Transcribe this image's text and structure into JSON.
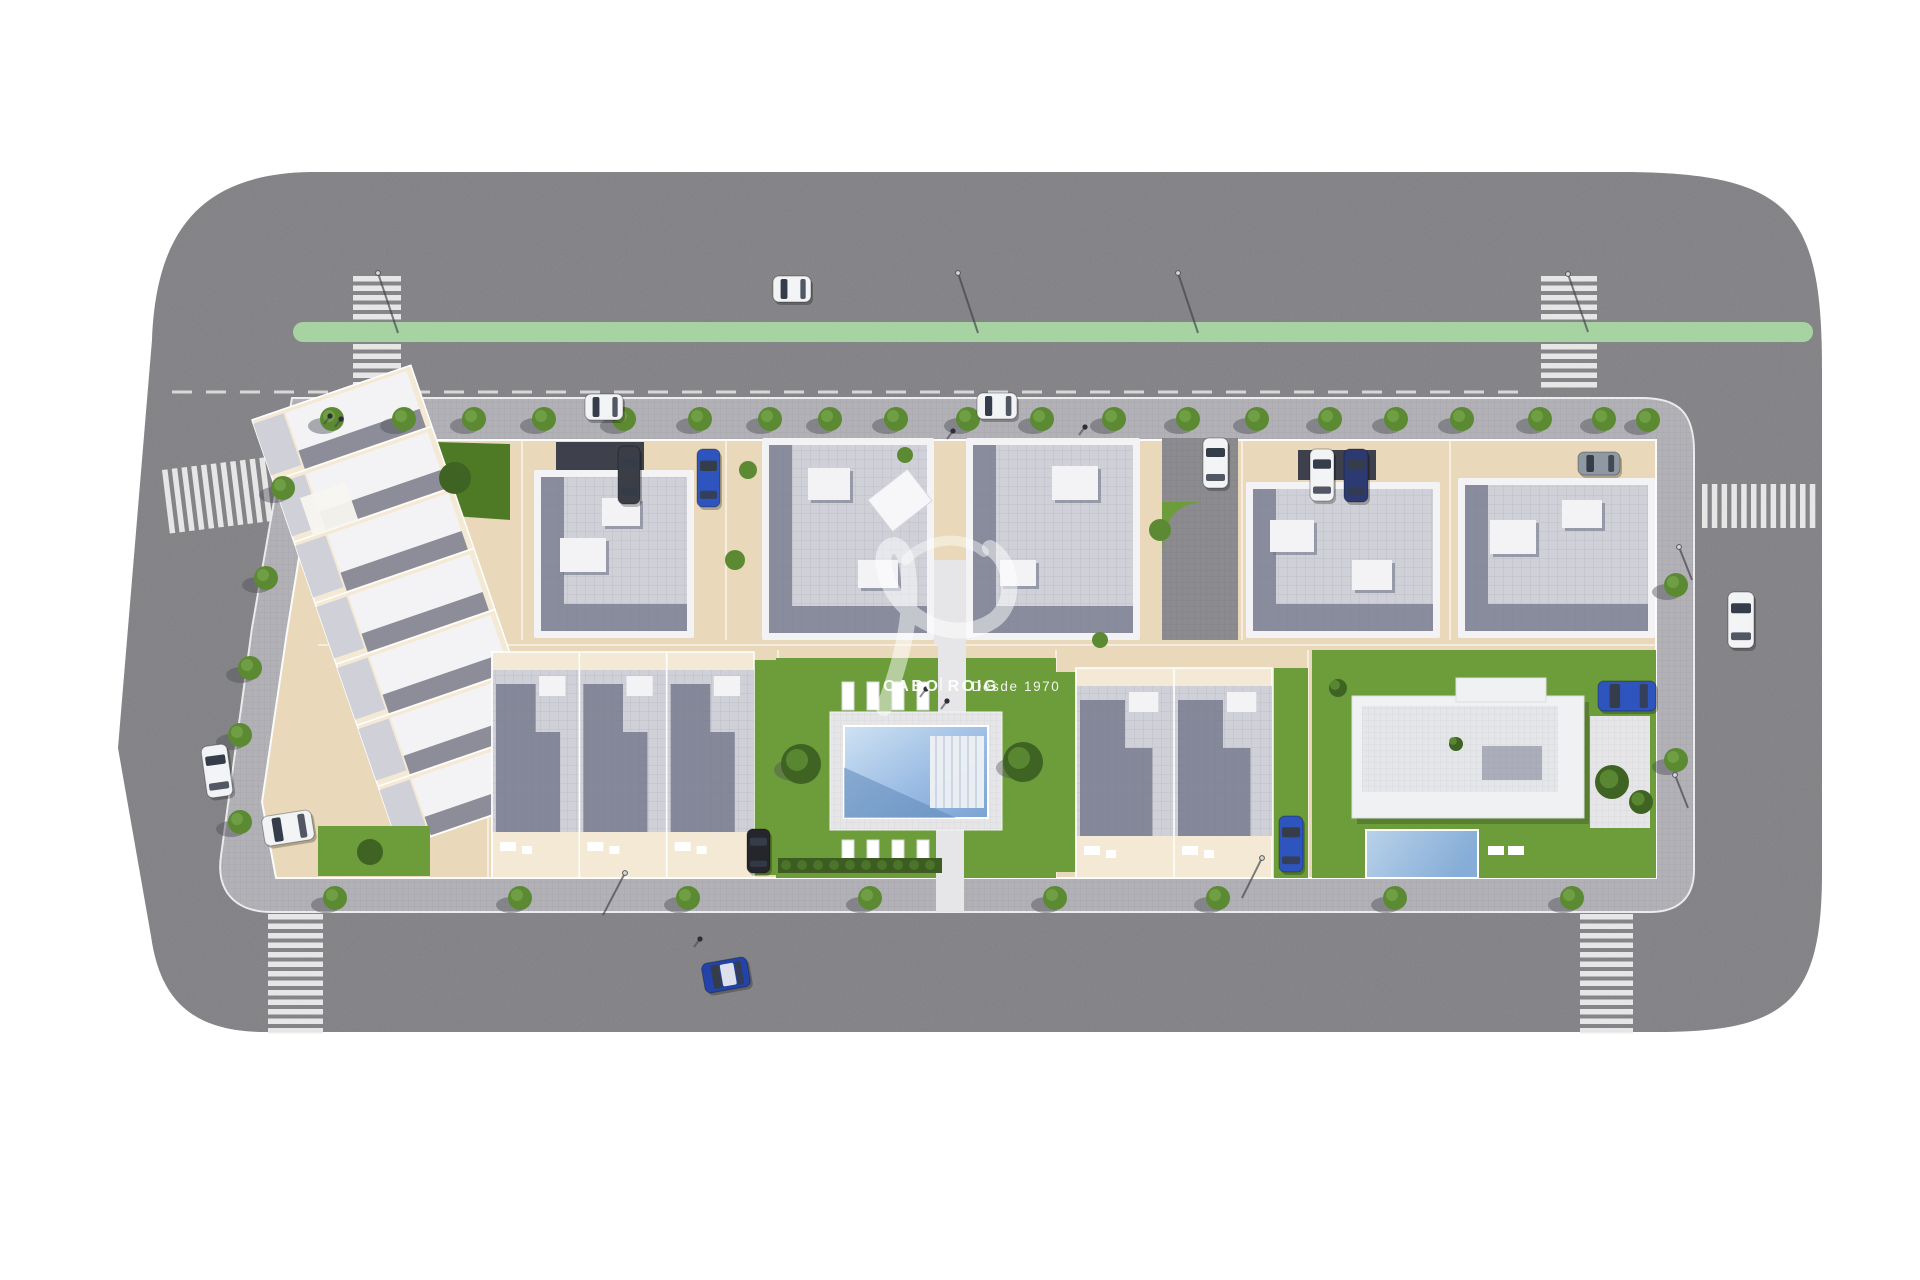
{
  "watermark": {
    "brand": "CABO ROIG",
    "tagline": "Desde 1970",
    "brand_x": 941,
    "brand_y": 691,
    "tag_x": 1016,
    "tag_y": 691,
    "swoosh1": "M 884,708 C 902,660 916,606 906,560 C 900,536 880,544 884,566 C 890,612 950,650 994,620 C 1018,602 1012,560 990,548",
    "swoosh2": "M 906,560 C 926,538 962,534 984,552"
  },
  "palette": {
    "asphalt": "#78787c",
    "driveway": "#8b8b90",
    "green_lane": "#a7d2a1",
    "sidewalk": "#b1b1b6",
    "curb": "#ececee",
    "block": "#e9d9ba",
    "block_light": "#f4e9d4",
    "lawn": "#6d9c3a",
    "lawn_dark": "#4e7a26",
    "hedge": "#3c5c22",
    "roof_white": "#f3f3f6",
    "roof_tile": "#cfd0d8",
    "roof_shadow": "#727689",
    "carport": "#3e414b",
    "deck": "#e6e6e8",
    "stripe": "#ebebeb",
    "car_white": "#f2f3f5",
    "car_blue": "#2e54bd",
    "car_blue2": "#2343a8",
    "car_navy": "#2c3a71",
    "car_black": "#25262c",
    "car_dark": "#3b3e47",
    "car_gray": "#9099a2",
    "glass": "#353c4a",
    "tree": "#5c8a33",
    "tree_dark": "#3f6323",
    "shadow": "#4e4f56"
  },
  "road": {
    "path": "M 310,172 L 1630,172 C 1790,174 1822,212 1822,368 L 1822,872 C 1822,1000 1788,1032 1658,1032 L 266,1032 C 192,1032 160,1000 151,936 L 118,748 L 152,340 C 156,232 200,174 310,172 Z",
    "green_lane": {
      "x": 293,
      "y": 322,
      "w": 1520,
      "h": 20,
      "r": 10
    },
    "dash_line": {
      "x1": 172,
      "y1": 392,
      "x2": 1532,
      "y2": 392
    }
  },
  "sidewalk_path": "M 292,398 L 1642,398 C 1680,398 1694,414 1694,452 L 1694,870 C 1694,898 1678,912 1650,912 L 272,912 C 234,912 216,890 221,856 L 252,628 Z",
  "block_path": "M 318,440 L 1656,440 L 1656,878 L 276,878 L 262,802 L 287,632 Z",
  "crosswalks": [
    {
      "type": "v",
      "x": 353,
      "y": 276,
      "w": 48,
      "count": 5,
      "pitch": 9.5,
      "rot": 0
    },
    {
      "type": "v",
      "x": 353,
      "y": 344,
      "w": 48,
      "count": 6,
      "pitch": 9.5,
      "rot": 0
    },
    {
      "type": "v",
      "x": 1541,
      "y": 276,
      "w": 56,
      "count": 5,
      "pitch": 9.5,
      "rot": 0
    },
    {
      "type": "v",
      "x": 1541,
      "y": 344,
      "w": 56,
      "count": 5,
      "pitch": 9.5,
      "rot": 0
    },
    {
      "type": "v",
      "x": 268,
      "y": 914,
      "w": 55,
      "count": 13,
      "pitch": 9.5,
      "rot": 0
    },
    {
      "type": "v",
      "x": 1580,
      "y": 914,
      "w": 53,
      "count": 13,
      "pitch": 9.5,
      "rot": 0
    },
    {
      "type": "h",
      "x": 162,
      "y": 470,
      "h": 64,
      "count": 12,
      "pitch": 9.8,
      "rot": -7
    },
    {
      "type": "h",
      "x": 1702,
      "y": 484,
      "h": 44,
      "count": 12,
      "pitch": 9.8,
      "rot": 0
    }
  ],
  "driveway": {
    "x": 1162,
    "y": 438,
    "w": 76,
    "h": 202,
    "green_corner": "M 1162,556 L 1162,502 L 1206,502 Q 1162,502 1162,556 Z",
    "car_index": 3
  },
  "terraced_west": {
    "tx": 252,
    "ty": 420,
    "rot": -19,
    "w": 168,
    "h": 452,
    "units": 7,
    "garden_top": "400,441 510,444 510,520 424,514",
    "garden_bottom": {
      "x": 318,
      "y": 826,
      "w": 112,
      "h": 50
    },
    "pergola": {
      "x": 300,
      "y": 498,
      "w": 48,
      "h": 40
    }
  },
  "apartments": [
    {
      "x": 534,
      "y": 470,
      "w": 160,
      "h": 168,
      "carport": {
        "x": 556,
        "y": 442,
        "w": 88,
        "h": 30
      },
      "boxes": [
        [
          560,
          538,
          46,
          34
        ],
        [
          602,
          498,
          38,
          28
        ]
      ]
    },
    {
      "x": 762,
      "y": 438,
      "w": 172,
      "h": 202,
      "boxes": [
        [
          808,
          468,
          42,
          32
        ],
        [
          858,
          560,
          40,
          28
        ]
      ],
      "diag": {
        "x": 868,
        "y": 500,
        "s": 50
      }
    },
    {
      "x": 966,
      "y": 438,
      "w": 174,
      "h": 202,
      "boxes": [
        [
          1052,
          466,
          46,
          34
        ],
        [
          1000,
          560,
          36,
          26
        ]
      ]
    },
    {
      "x": 1246,
      "y": 482,
      "w": 194,
      "h": 156,
      "carport": {
        "x": 1298,
        "y": 450,
        "w": 78,
        "h": 30
      },
      "boxes": [
        [
          1270,
          520,
          44,
          32
        ],
        [
          1352,
          560,
          40,
          30
        ]
      ]
    },
    {
      "x": 1458,
      "y": 478,
      "w": 197,
      "h": 160,
      "boxes": [
        [
          1490,
          520,
          46,
          34
        ],
        [
          1562,
          500,
          40,
          28
        ]
      ]
    }
  ],
  "court": {
    "x": 934,
    "y": 560,
    "w": 32,
    "h": 84
  },
  "townhouse_rows": [
    {
      "x": 492,
      "y": 652,
      "w": 262,
      "h": 226,
      "units": 3,
      "patio_h": 46,
      "lawns": [
        [
          754,
          660,
          22,
          215
        ]
      ]
    },
    {
      "x": 1076,
      "y": 668,
      "w": 196,
      "h": 210,
      "units": 2,
      "patio_h": 42,
      "lawns": [
        [
          1052,
          672,
          24,
          200
        ],
        [
          1274,
          668,
          34,
          210
        ]
      ]
    }
  ],
  "property_lines": {
    "v1": [
      522,
      726,
      1242,
      1450
    ],
    "v1y": [
      440,
      640
    ],
    "v2": [
      488,
      778,
      1056,
      1308
    ],
    "v2y": [
      650,
      878
    ],
    "hy": 645,
    "hx": [
      318,
      1656
    ]
  },
  "garden": {
    "lawn": {
      "x": 776,
      "y": 658,
      "w": 280,
      "h": 220
    },
    "deck": {
      "x": 830,
      "y": 712,
      "w": 172,
      "h": 118
    },
    "pool": {
      "x": 844,
      "y": 726,
      "w": 144,
      "h": 92
    },
    "steps": {
      "x": 930,
      "y": 736,
      "w": 54,
      "h": 72
    },
    "loungers_x": [
      842,
      867,
      892,
      917
    ],
    "loungers_y": [
      682,
      840
    ],
    "lounger": {
      "w": 12,
      "h": 28
    },
    "bushes": [
      [
        801,
        764,
        20
      ],
      [
        1023,
        762,
        20
      ]
    ],
    "hedge": {
      "x": 778,
      "y": 858,
      "w": 164,
      "h": 15
    },
    "path_bottom": {
      "x": 936,
      "y": 828,
      "w": 28,
      "h": 84
    },
    "path_top": {
      "x": 938,
      "y": 586,
      "w": 28,
      "h": 126
    }
  },
  "villa": {
    "plot": {
      "x": 1312,
      "y": 650,
      "w": 344,
      "h": 228
    },
    "base": {
      "x": 1352,
      "y": 696,
      "w": 232,
      "h": 122
    },
    "roof": {
      "x": 1362,
      "y": 706,
      "w": 196,
      "h": 86
    },
    "wing": {
      "x": 1456,
      "y": 678,
      "w": 90,
      "h": 24
    },
    "pool": {
      "x": 1366,
      "y": 830,
      "w": 112,
      "h": 48
    },
    "path": {
      "x": 1590,
      "y": 716,
      "w": 60,
      "h": 112
    },
    "bushes": [
      [
        1612,
        782,
        17
      ],
      [
        1641,
        802,
        12
      ],
      [
        1338,
        688,
        9
      ],
      [
        1456,
        744,
        7
      ]
    ],
    "loungers": [
      [
        1488,
        846
      ],
      [
        1508,
        846
      ]
    ]
  },
  "trees": {
    "top_y": 419,
    "top_x": [
      332,
      404,
      474,
      544,
      624,
      700,
      770,
      830,
      896,
      968,
      1042,
      1114,
      1188,
      1257,
      1330,
      1396,
      1462,
      1540,
      1604
    ],
    "bottom_y": 898,
    "bottom_x": [
      335,
      520,
      688,
      870,
      1055,
      1218,
      1395,
      1572
    ],
    "left": [
      [
        283,
        488
      ],
      [
        266,
        578
      ],
      [
        250,
        668
      ],
      [
        240,
        735
      ],
      [
        240,
        822
      ]
    ],
    "right": [
      [
        1648,
        420
      ],
      [
        1676,
        585
      ],
      [
        1676,
        760
      ]
    ],
    "misc": [
      [
        455,
        478,
        16,
        1
      ],
      [
        370,
        852,
        13,
        1
      ],
      [
        735,
        560,
        10,
        0
      ],
      [
        748,
        470,
        9,
        0
      ],
      [
        1160,
        530,
        11,
        0
      ],
      [
        905,
        455,
        8,
        0
      ],
      [
        1100,
        640,
        8,
        0
      ]
    ]
  },
  "cars": [
    {
      "x": 773,
      "y": 276,
      "w": 38,
      "h": 26,
      "rot": 0,
      "c": "car_white"
    },
    {
      "x": 585,
      "y": 394,
      "w": 38,
      "h": 26,
      "rot": 0,
      "c": "car_white"
    },
    {
      "x": 977,
      "y": 393,
      "w": 40,
      "h": 26,
      "rot": 0,
      "c": "car_white"
    },
    {
      "x": 1203,
      "y": 438,
      "w": 25,
      "h": 50,
      "rot": 0,
      "c": "car_white"
    },
    {
      "x": 1310,
      "y": 449,
      "w": 24,
      "h": 52,
      "rot": 0,
      "c": "car_white"
    },
    {
      "x": 1344,
      "y": 449,
      "w": 24,
      "h": 53,
      "rot": 0,
      "c": "car_navy"
    },
    {
      "x": 1578,
      "y": 452,
      "w": 42,
      "h": 23,
      "rot": 0,
      "c": "car_gray"
    },
    {
      "x": 1728,
      "y": 592,
      "w": 26,
      "h": 56,
      "rot": 0,
      "c": "car_white"
    },
    {
      "x": 1598,
      "y": 681,
      "w": 58,
      "h": 30,
      "rot": 0,
      "c": "car_blue"
    },
    {
      "x": 1279,
      "y": 816,
      "w": 24,
      "h": 56,
      "rot": 0,
      "c": "car_blue"
    },
    {
      "x": 747,
      "y": 829,
      "w": 23,
      "h": 44,
      "rot": 0,
      "c": "car_black"
    },
    {
      "x": 618,
      "y": 446,
      "w": 22,
      "h": 58,
      "rot": 0,
      "c": "car_dark"
    },
    {
      "x": 697,
      "y": 449,
      "w": 23,
      "h": 58,
      "rot": 0,
      "c": "car_blue"
    },
    {
      "x": 204,
      "y": 745,
      "w": 26,
      "h": 52,
      "rot": -8,
      "c": "car_white"
    },
    {
      "x": 263,
      "y": 813,
      "w": 50,
      "h": 30,
      "rot": -9,
      "c": "car_white"
    },
    {
      "x": 703,
      "y": 960,
      "w": 46,
      "h": 30,
      "rot": -10,
      "c": "car_blue2"
    }
  ],
  "people": [
    [
      330,
      416
    ],
    [
      341,
      419
    ],
    [
      953,
      431
    ],
    [
      1085,
      427
    ],
    [
      926,
      689
    ],
    [
      947,
      701
    ],
    [
      700,
      939
    ]
  ],
  "lamps": [
    {
      "x": 378,
      "y": 273,
      "dx": 20,
      "dy": 60
    },
    {
      "x": 958,
      "y": 273,
      "dx": 20,
      "dy": 60
    },
    {
      "x": 1178,
      "y": 273,
      "dx": 20,
      "dy": 60
    },
    {
      "x": 1568,
      "y": 274,
      "dx": 20,
      "dy": 58
    },
    {
      "x": 625,
      "y": 873,
      "dx": -22,
      "dy": 42
    },
    {
      "x": 1262,
      "y": 858,
      "dx": -20,
      "dy": 40
    },
    {
      "x": 1679,
      "y": 547,
      "dx": 13,
      "dy": 33
    },
    {
      "x": 1675,
      "y": 775,
      "dx": 13,
      "dy": 33
    }
  ]
}
